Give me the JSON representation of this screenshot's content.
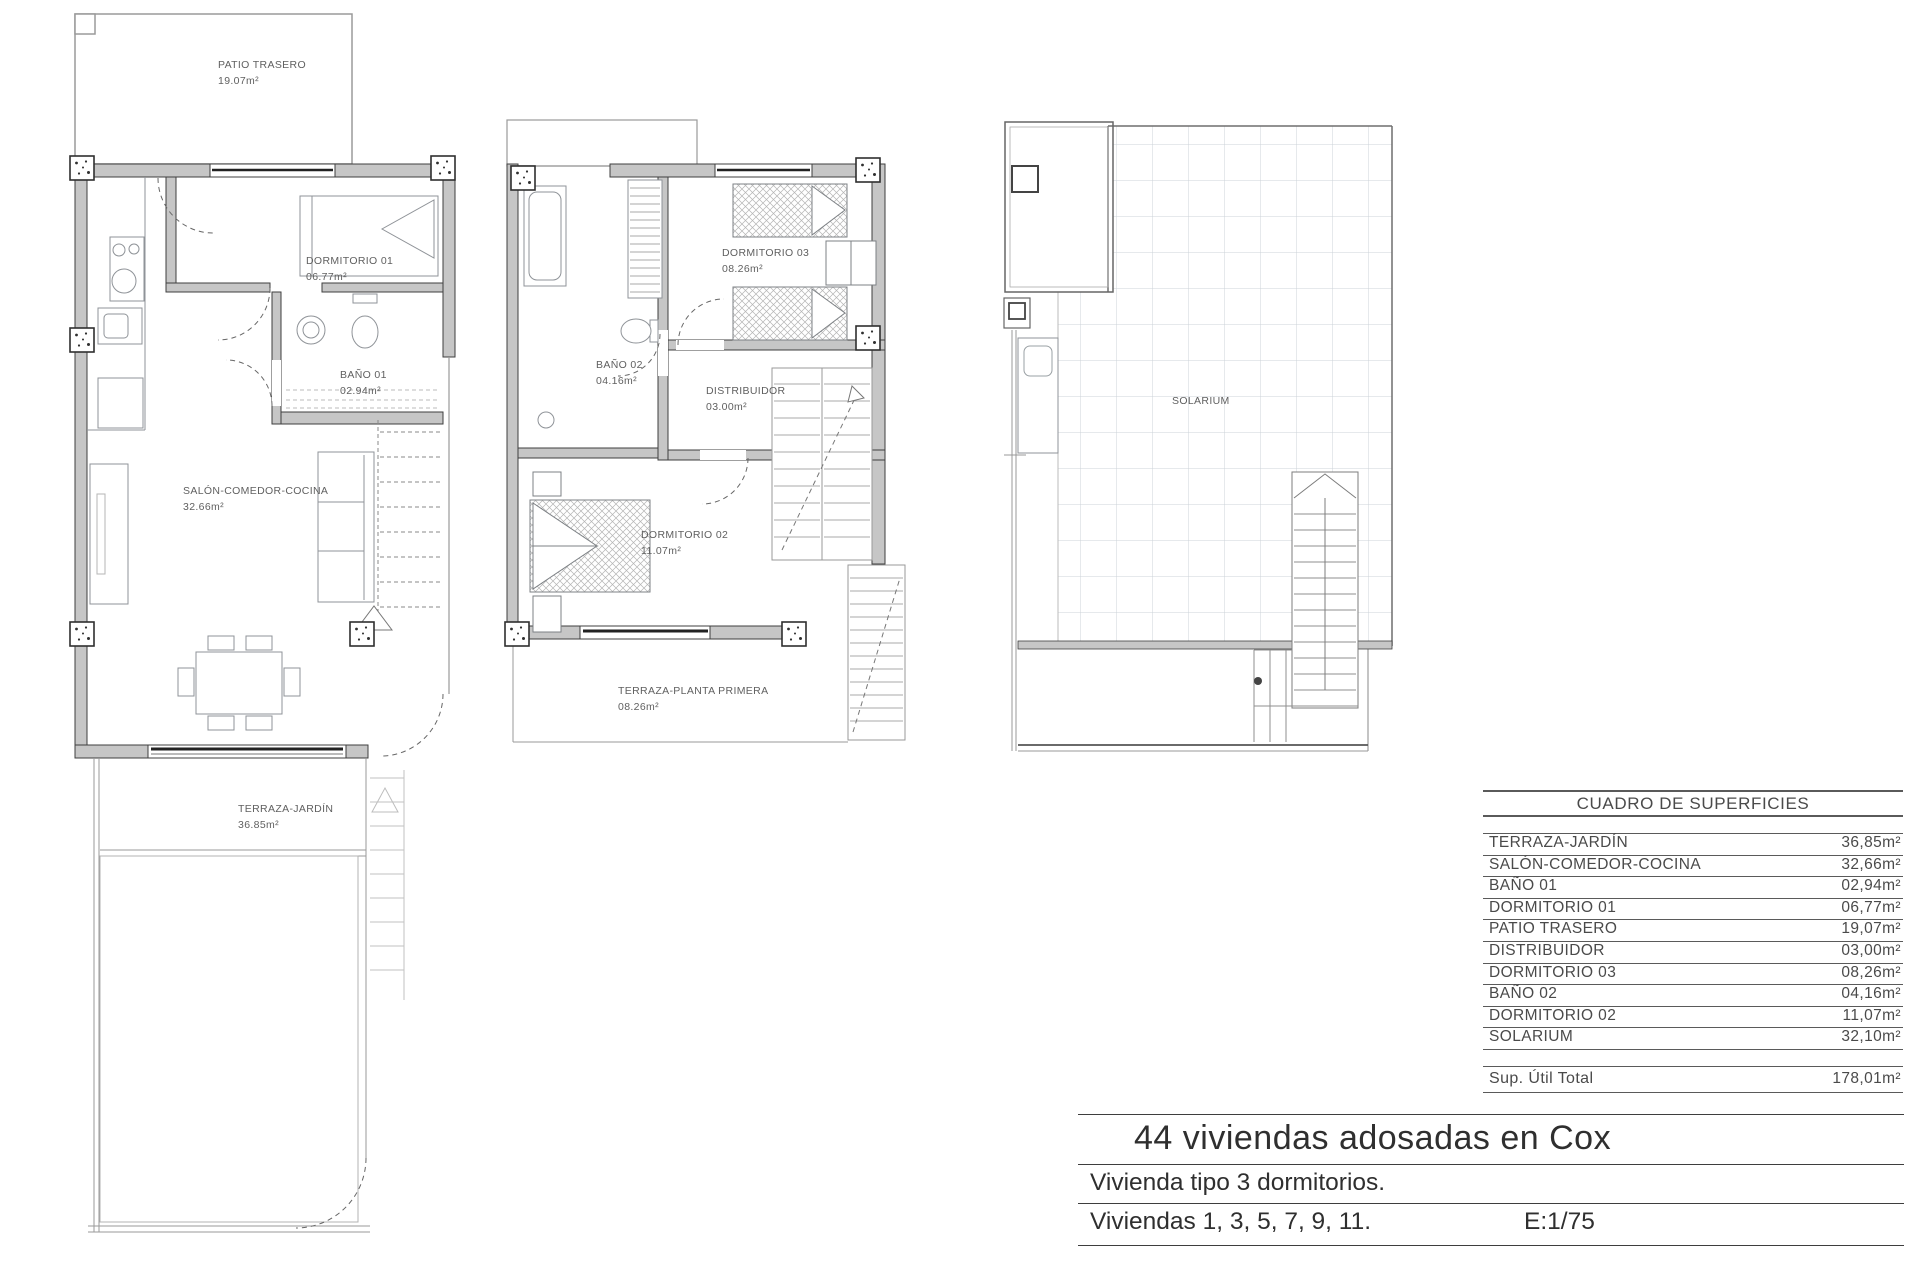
{
  "document": {
    "title": "44 viviendas adosadas en Cox",
    "subtitle": "Vivienda tipo 3 dormitorios.",
    "units_line": "Viviendas 1, 3, 5, 7, 9, 11.",
    "scale": "E:1/75"
  },
  "plans": {
    "ground_floor": {
      "rooms": [
        {
          "name": "PATIO TRASERO",
          "area": "19.07m²"
        },
        {
          "name": "DORMITORIO 01",
          "area": "06.77m²"
        },
        {
          "name": "BAÑO 01",
          "area": "02.94m²"
        },
        {
          "name": "SALÓN-COMEDOR-COCINA",
          "area": "32.66m²"
        },
        {
          "name": "TERRAZA-JARDÍN",
          "area": "36.85m²"
        }
      ]
    },
    "first_floor": {
      "rooms": [
        {
          "name": "DORMITORIO 03",
          "area": "08.26m²"
        },
        {
          "name": "BAÑO 02",
          "area": "04.16m²"
        },
        {
          "name": "DISTRIBUIDOR",
          "area": "03.00m²"
        },
        {
          "name": "DORMITORIO 02",
          "area": "11.07m²"
        },
        {
          "name": "TERRAZA-PLANTA PRIMERA",
          "area": "08.26m²"
        }
      ]
    },
    "roof": {
      "rooms": [
        {
          "name": "SOLARIUM",
          "area": ""
        }
      ]
    }
  },
  "surface_table": {
    "title": "CUADRO DE SUPERFICIES",
    "rows": [
      {
        "label": "TERRAZA-JARDÍN",
        "value": "36,85m²"
      },
      {
        "label": "SALÓN-COMEDOR-COCINA",
        "value": "32,66m²"
      },
      {
        "label": "BAÑO 01",
        "value": "02,94m²"
      },
      {
        "label": "DORMITORIO 01",
        "value": "06,77m²"
      },
      {
        "label": "PATIO TRASERO",
        "value": "19,07m²"
      },
      {
        "label": "DISTRIBUIDOR",
        "value": "03,00m²"
      },
      {
        "label": "DORMITORIO 03",
        "value": "08,26m²"
      },
      {
        "label": "BAÑO 02",
        "value": "04,16m²"
      },
      {
        "label": "DORMITORIO 02",
        "value": "11,07m²"
      },
      {
        "label": "SOLARIUM",
        "value": "32,10m²"
      }
    ],
    "total_label": "Sup. Útil Total",
    "total_value": "178,01m²"
  }
}
